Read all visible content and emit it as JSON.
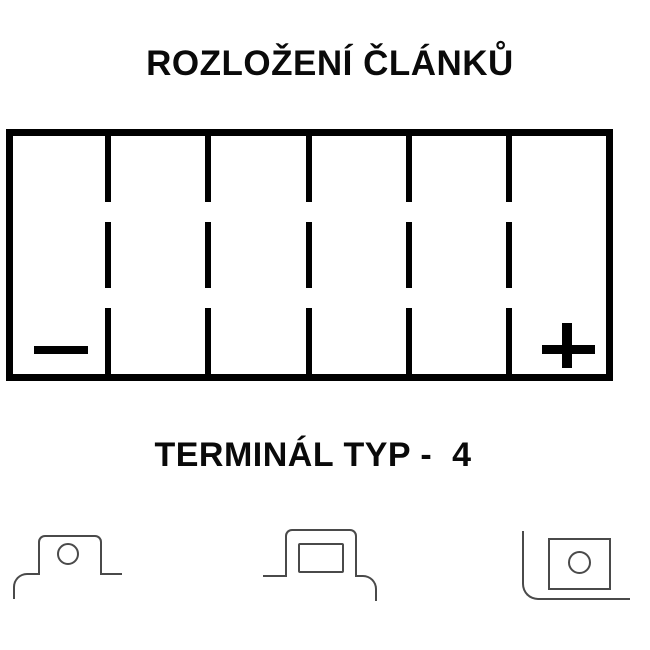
{
  "colors": {
    "background": "#ffffff",
    "ink": "#000000",
    "line_art": "#4a4a4a"
  },
  "cell_layout": {
    "title": "ROZLOŽENÍ ČLÁNKŮ",
    "cell_count": 6,
    "divider_style": "dashed",
    "negative_symbol": "−",
    "positive_symbol": "+",
    "negative_position": "left",
    "positive_position": "right"
  },
  "terminal_section": {
    "heading": "TERMINÁL TYP -  4",
    "type_number": "4",
    "views": [
      {
        "id": "side-view-left-corner",
        "feature": "rounded terminal block with round hole"
      },
      {
        "id": "side-view-right-corner",
        "feature": "rounded terminal block with square recess"
      },
      {
        "id": "top-view-corner",
        "feature": "square terminal plate with round hole"
      }
    ]
  }
}
